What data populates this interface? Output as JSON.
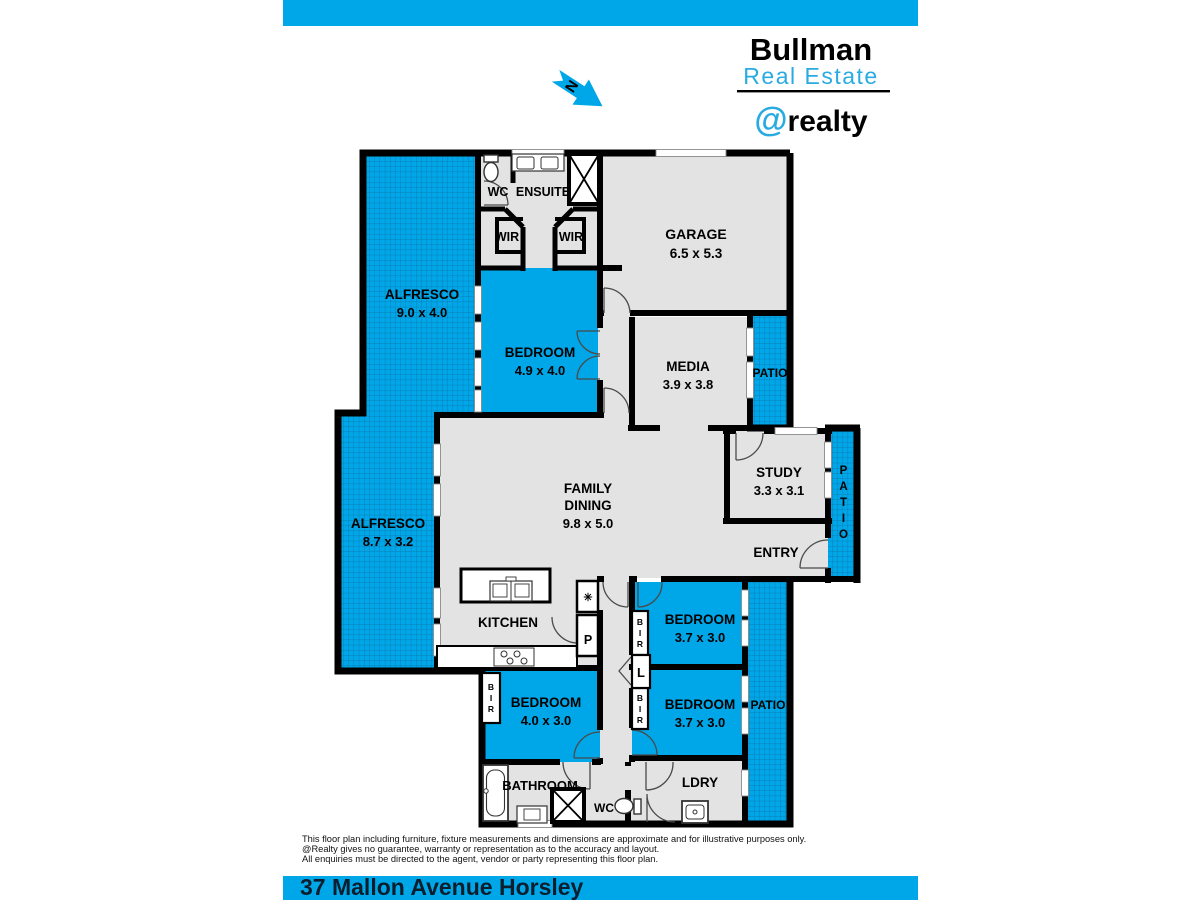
{
  "colors": {
    "brand_blue": "#00a7e8",
    "logo_blue": "#29abe2",
    "hatch_line": "#0b7fb6",
    "room_gray": "#e3e3e3",
    "wall_black": "#000000",
    "address_text": "#0a1e2d"
  },
  "header": {
    "brand_top": "Bullman",
    "brand_mid": "Real Estate",
    "brand_at": "@",
    "brand_rest": "realty"
  },
  "compass": {
    "letter": "N"
  },
  "plan": {
    "alfresco1": {
      "label": "ALFRESCO",
      "dim": "9.0 x 4.0"
    },
    "alfresco2": {
      "label": "ALFRESCO",
      "dim": "8.7 x 3.2"
    },
    "wc_top": {
      "label": "WC"
    },
    "ensuite": {
      "label": "ENSUITE"
    },
    "wir1": {
      "label": "WIR"
    },
    "wir2": {
      "label": "WIR"
    },
    "bed1": {
      "label": "BEDROOM",
      "dim": "4.9 x 4.0"
    },
    "garage": {
      "label": "GARAGE",
      "dim": "6.5 x 5.3"
    },
    "media": {
      "label": "MEDIA",
      "dim": "3.9 x 3.8"
    },
    "patio_media": {
      "label": "PATIO"
    },
    "study": {
      "label": "STUDY",
      "dim": "3.3 x 3.1"
    },
    "patio_entry": {
      "letters": [
        "P",
        "A",
        "T",
        "I",
        "O"
      ]
    },
    "entry": {
      "label": "ENTRY"
    },
    "family": {
      "line1": "FAMILY",
      "line2": "DINING",
      "dim": "9.8 x 5.0"
    },
    "kitchen": {
      "label": "KITCHEN"
    },
    "pantry": {
      "label": "P"
    },
    "fan": {
      "symbol": "✳"
    },
    "bed2": {
      "label": "BEDROOM",
      "dim": "4.0 x 3.0"
    },
    "bed3": {
      "label": "BEDROOM",
      "dim": "3.7 x 3.0"
    },
    "bed4": {
      "label": "BEDROOM",
      "dim": "3.7 x 3.0"
    },
    "linen": {
      "label": "L"
    },
    "bir": {
      "letters": [
        "B",
        "I",
        "R"
      ]
    },
    "bathroom": {
      "label": "BATHROOM"
    },
    "wc_bottom": {
      "label": "WC"
    },
    "laundry": {
      "label": "LDRY"
    },
    "patio_bed": {
      "label": "PATIO"
    }
  },
  "disclaimer": {
    "line1": "This floor plan including furniture, fixture measurements and dimensions are approximate and for illustrative purposes only.",
    "line2": "@Realty gives no guarantee, warranty or representation as to the accuracy and layout.",
    "line3": "All enquiries must be directed to the agent, vendor or party representing this floor plan."
  },
  "footer": {
    "address": "37 Mallon Avenue Horsley"
  }
}
